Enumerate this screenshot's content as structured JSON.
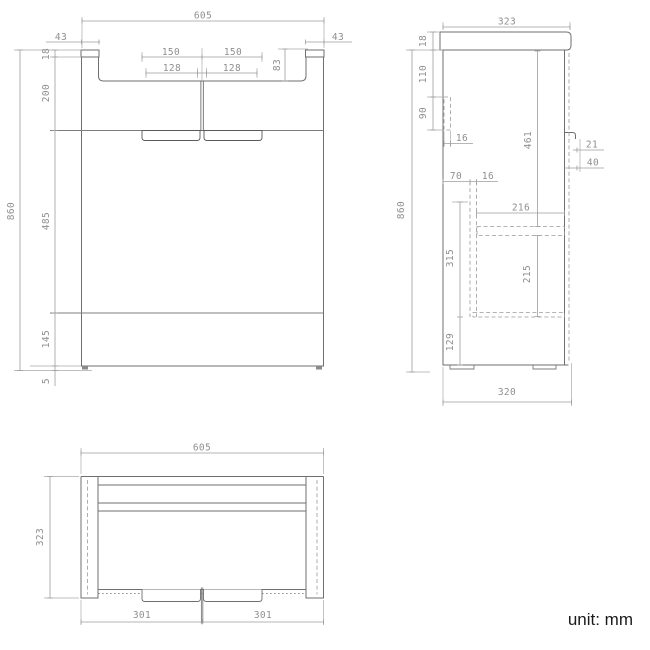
{
  "unit_label": "unit: mm",
  "front": {
    "total_width": "605",
    "cap_width_left": "43",
    "cap_width_right": "43",
    "handle_span_left": "150",
    "handle_span_right": "150",
    "handle_inner_left": "128",
    "handle_inner_right": "128",
    "top_recess_height": "83",
    "countertop_thickness": "18",
    "upper_section_height": "200",
    "middle_section_height": "485",
    "lower_section_height": "145",
    "foot_height": "5",
    "total_height": "860"
  },
  "side": {
    "top_depth": "323",
    "countertop_thickness": "18",
    "offset_top": "110",
    "rail_height": "90",
    "rail_thickness": "16",
    "back_gap": "70",
    "panel_thickness": "16",
    "shelf_depth": "216",
    "interior_height": "461",
    "drawer_zone_height": "315",
    "shelf_spacing": "215",
    "bottom_zone_height": "129",
    "handle_offset": "21",
    "handle_depth": "40",
    "bottom_depth": "320",
    "total_height": "860"
  },
  "top": {
    "total_width": "605",
    "total_depth": "323",
    "door_width_left": "301",
    "door_width_right": "301"
  }
}
